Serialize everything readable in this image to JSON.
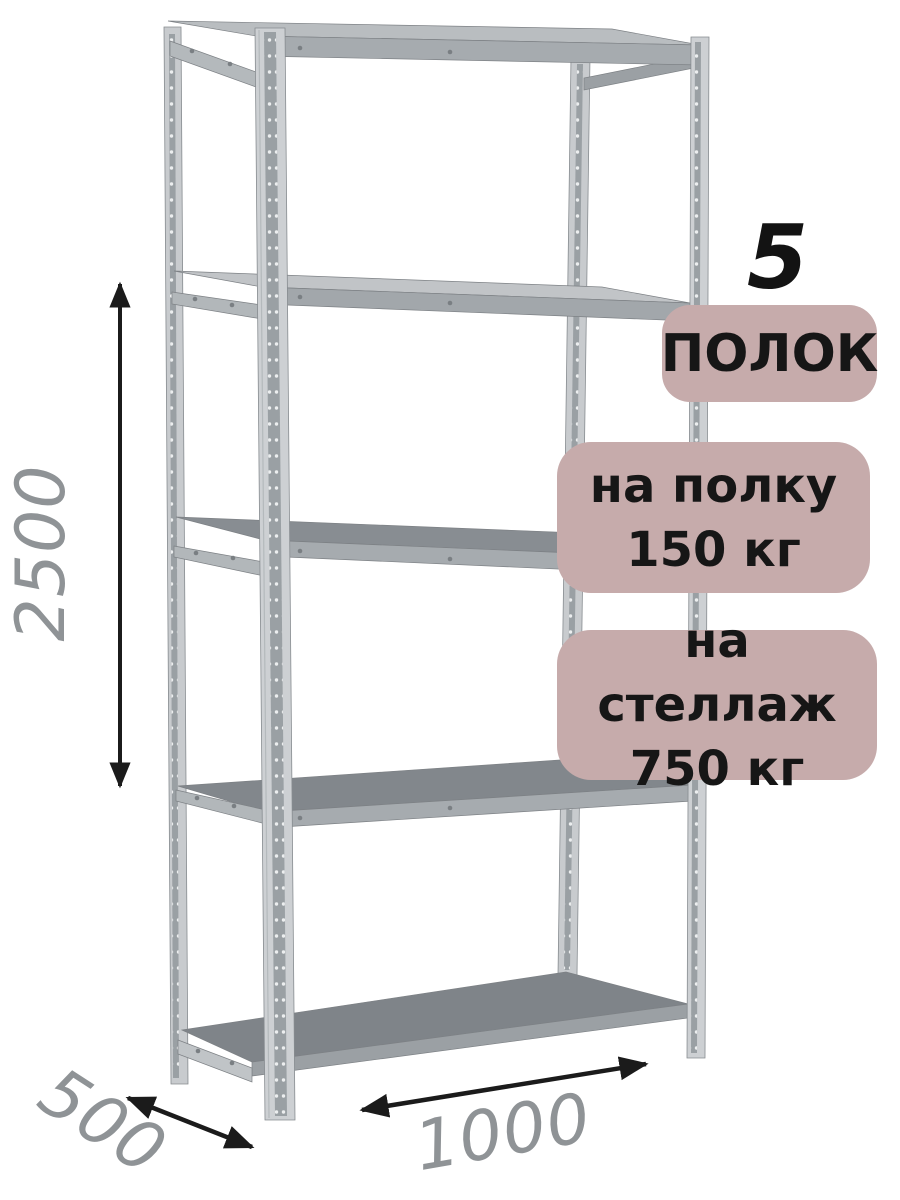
{
  "annotations": {
    "shelf_count": {
      "number": "5",
      "label": "ПОЛОК"
    },
    "per_shelf_load": {
      "line1": "на полку",
      "line2": "150 кг"
    },
    "per_rack_load": {
      "line1": "на стеллаж",
      "line2": "750 кг"
    }
  },
  "dimensions": {
    "height": "2500",
    "depth": "500",
    "width": "1000"
  },
  "colors": {
    "background": "#ffffff",
    "badge_background": "#c6abab",
    "badge_text": "#161616",
    "dimension_label": "#8f9396",
    "dimension_arrow": "#1b1b1b",
    "metal_light": "#cdd0d3",
    "metal_medium": "#a6abaf",
    "metal_dark": "#82878c",
    "shelf_surface": "#868b90"
  }
}
